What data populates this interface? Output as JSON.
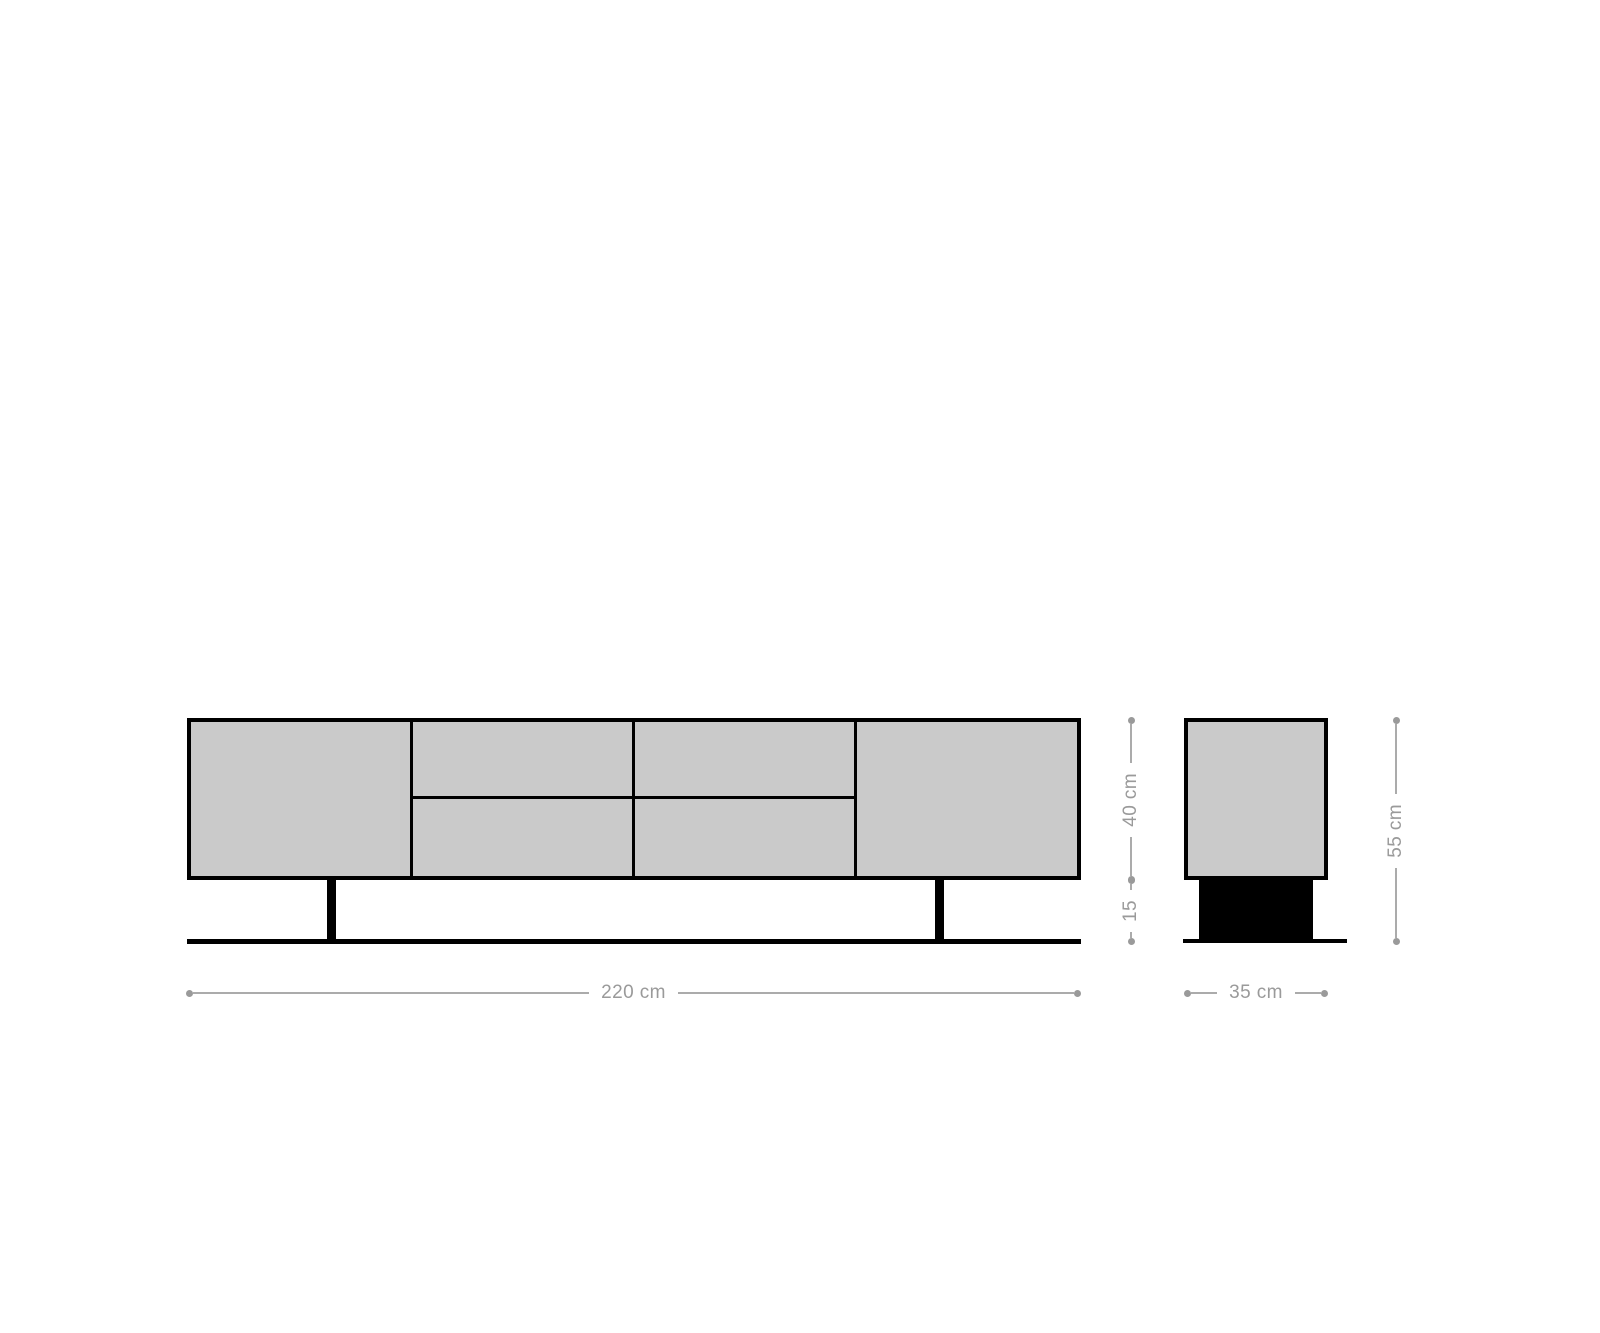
{
  "diagram": {
    "subject": "lowboard-dimension-drawing",
    "dimensions": {
      "width": "220 cm",
      "depth": "35 cm",
      "body_height": "40 cm",
      "base_height": "15",
      "total_height": "55 cm"
    },
    "colors": {
      "panel_fill": "#cacaca",
      "outline": "#000000",
      "dimension_gray": "#9a9a9a",
      "background": "#ffffff"
    }
  }
}
